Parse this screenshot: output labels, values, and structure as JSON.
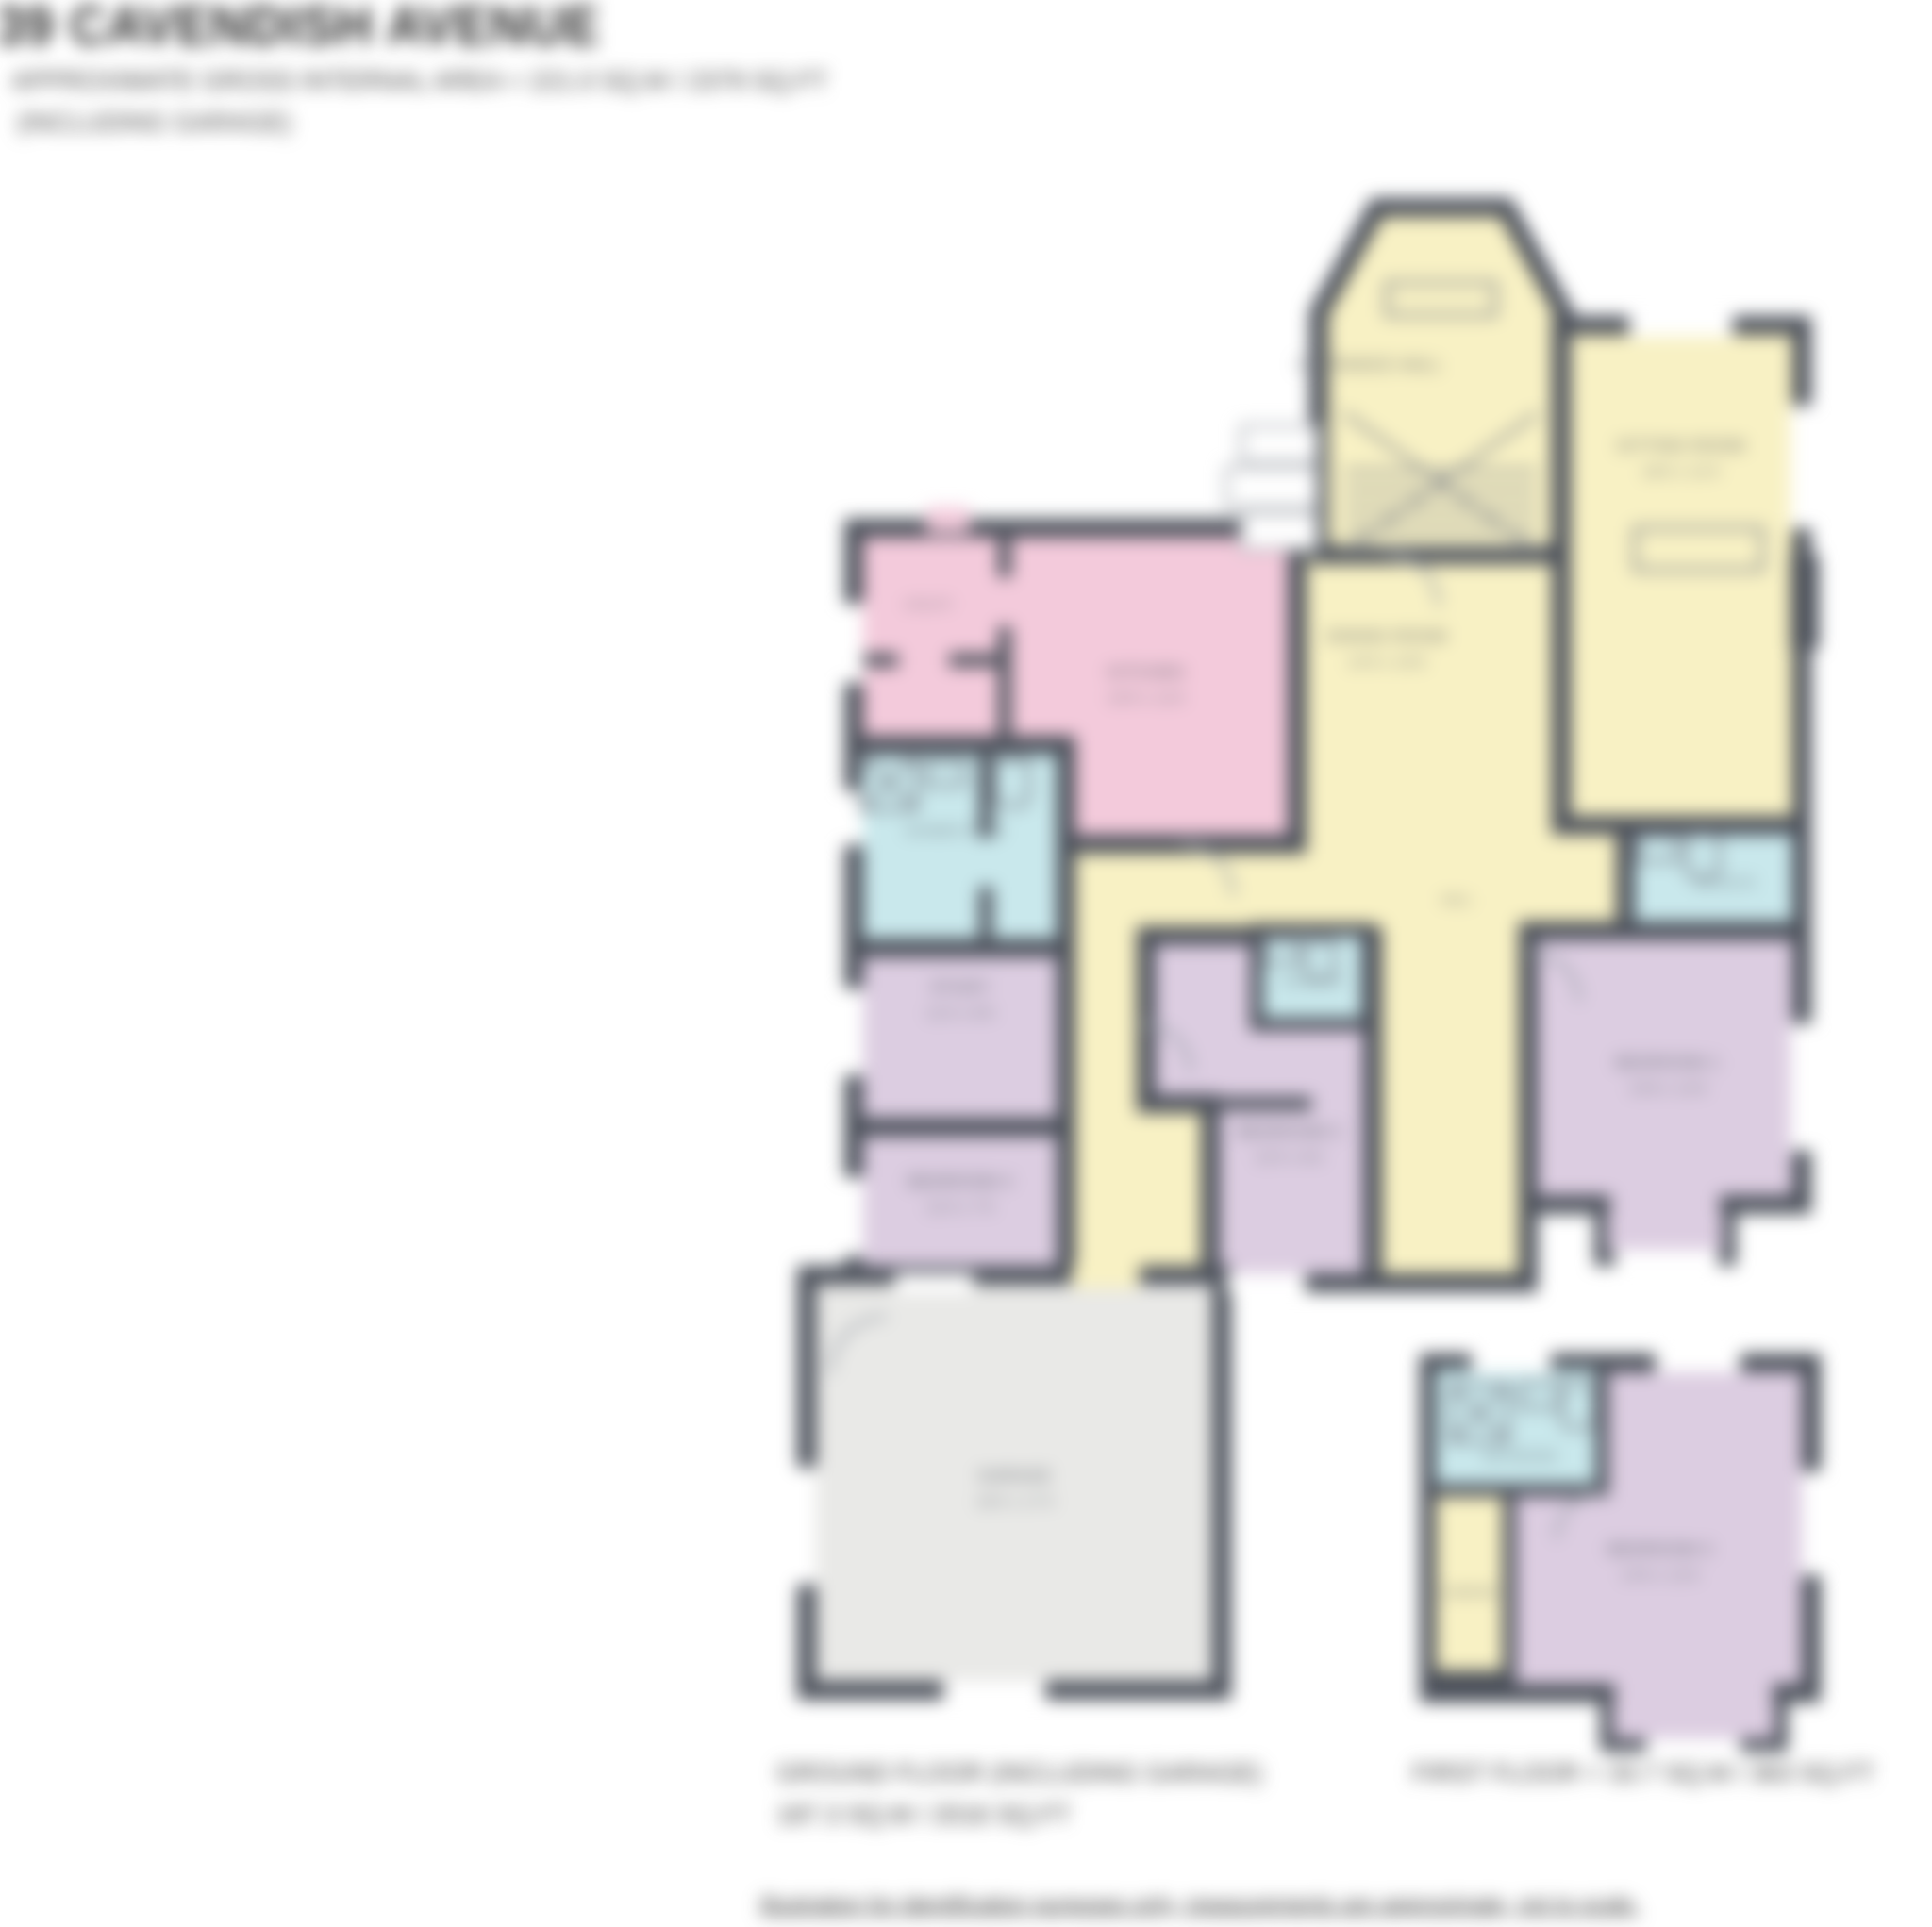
{
  "document": {
    "title": "39 CAVENDISH AVENUE",
    "subtitle": "APPROXIMATE GROSS INTERNAL AREA = 221.0 SQ.M / 2379 SQ.FT",
    "subtitle2": "(INCLUDING GARAGE)",
    "footer_disclaimer": "Illustration for identification purposes only, measurements are approximate, not to scale."
  },
  "captions": {
    "ground_floor_line1": "GROUND FLOOR (INCLUDING GARAGE)",
    "ground_floor_line2": "187.3 SQ.M / 2016 SQ.FT",
    "first_floor": "FIRST FLOOR = 33.7 SQ.M / 363 SQ.FT"
  },
  "palette": {
    "wall": "#4b505a",
    "reception": "#f8f1c4",
    "kitchen": "#f3cadb",
    "bath": "#c9e8ec",
    "bedroom": "#dccde1",
    "garage": "#e9e9e7",
    "fixture": "#7c818a",
    "door_arc": "#9aa0a8",
    "window": "#ffffff",
    "step_edge": "#b9bcc1",
    "label_text": "#565b63",
    "dims_text": "#6a6f76"
  },
  "rooms": {
    "entrance_hall": {
      "label": "ENTRANCE HALL"
    },
    "sitting_room": {
      "name": "SITTING ROOM",
      "dims": "18'6 x 12'4"
    },
    "dining_room": {
      "name": "DINING ROOM",
      "dims": "14'9 x 10'6"
    },
    "kitchen": {
      "name": "KITCHEN",
      "dims": "15'9 x 11'6"
    },
    "utility": {
      "label": "UTILITY"
    },
    "shower_room": {
      "label": "SHOWER ROOM"
    },
    "study": {
      "name": "STUDY",
      "dims": "11'0 x 8'9"
    },
    "bedroom_4": {
      "name": "BEDROOM 4",
      "dims": "11'0 x 7'5"
    },
    "bedroom_2": {
      "name": "BEDROOM 2",
      "dims": "12'5 x 8'2"
    },
    "en_suite_1": {
      "label": "EN-SUITE"
    },
    "en_suite_2": {
      "label": "EN-SUITE"
    },
    "bedroom_1": {
      "name": "BEDROOM 1",
      "dims": "13'8 x 12'6"
    },
    "hall": {
      "label": "HALL"
    },
    "garage": {
      "name": "GARAGE",
      "dims": "18'0 x 17'3"
    },
    "bathroom": {
      "label": "BATHROOM"
    },
    "landing": {
      "label": "LANDING"
    },
    "bedroom_3": {
      "name": "BEDROOM 3",
      "dims": "14'6 x 12'0"
    }
  }
}
